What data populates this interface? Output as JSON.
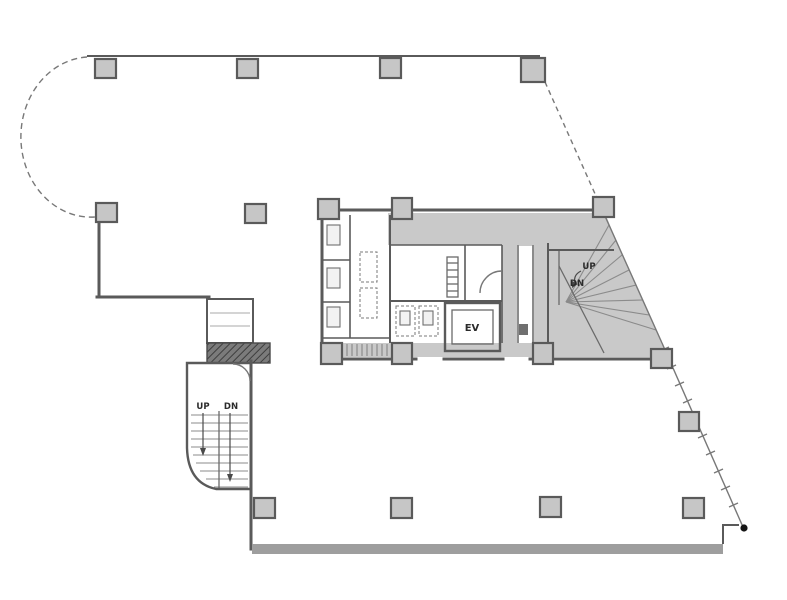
{
  "figure": {
    "type": "architectural-floor-plan",
    "description": "Single floor plan of a building with rounded north-west corner, diagonal east wall, central service core and two staircases"
  },
  "labels": {
    "elevator": "EV",
    "core_stair": {
      "up": "UP",
      "down": "DN"
    },
    "exterior_stair": {
      "up": "UP",
      "down": "DN"
    }
  },
  "colors": {
    "wall": "#5a5a5a",
    "line": "#787878",
    "core": "#c9c9c9",
    "column": "#c6c6c6",
    "band": "#9e9e9e",
    "hatchBase": "#7b7b7b",
    "hatchLine": "#3e3e3e",
    "text": "#2b2b2b",
    "dot": "#151515",
    "bg": "#ffffff",
    "tread": "#8b8b8b"
  }
}
